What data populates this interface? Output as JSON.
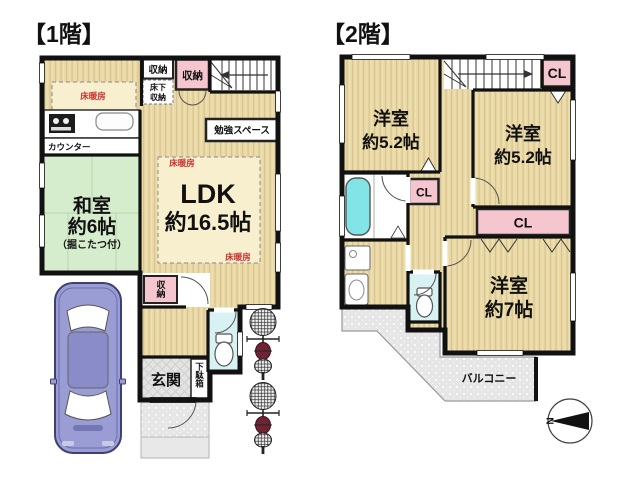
{
  "f1": {
    "title": "【1階】",
    "washitsu": [
      "和室",
      "約6帖",
      "（掘こたつ付）"
    ],
    "ldk": [
      "LDK",
      "約16.5帖"
    ],
    "genkan": "玄関",
    "getabako": "下駄箱",
    "counter": "カウンター",
    "study": "勉強スペース",
    "storage": "収納",
    "underfloor": [
      "床下",
      "収納"
    ],
    "heating": "床暖房"
  },
  "f2": {
    "title": "【2階】",
    "west_a": [
      "洋室",
      "約5.2帖"
    ],
    "west_b": [
      "洋室",
      "約5.2帖"
    ],
    "west_c": [
      "洋室",
      "約7帖"
    ],
    "balcony": "バルコニー",
    "closet": "CL"
  },
  "compass": {
    "north": "N"
  },
  "colors": {
    "wood": "#e9d9a6",
    "wood_stripe": "#d8c289",
    "heating_area": "#f7efce",
    "tatami": "#d6edcd",
    "closet_pink": "#f5c6cd",
    "bath_cyan": "#82e4e6",
    "toilet_floor": "#d8f2f4",
    "gray_floor": "#e6e6e6",
    "wall": "#111111",
    "heating_label": "#cc3333",
    "car_body": "#9a9cd4"
  }
}
